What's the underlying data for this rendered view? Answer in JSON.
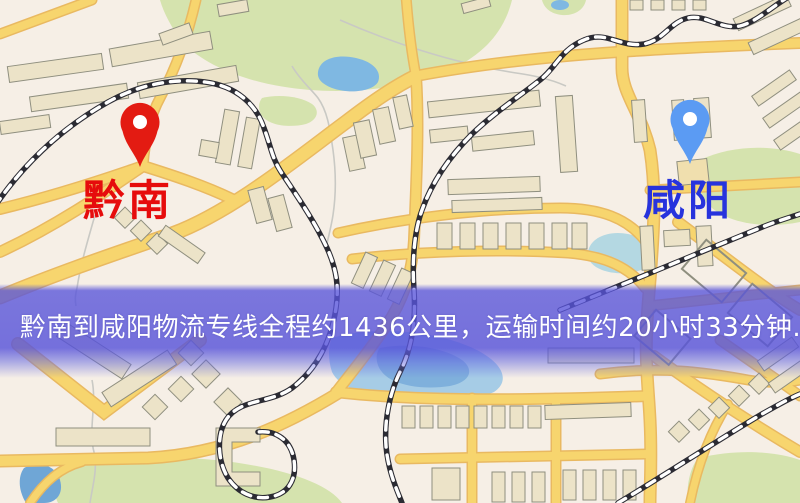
{
  "banner": {
    "text": "黔南到咸阳物流专线全程约1436公里，运输时间约20小时33分钟.",
    "background_color": "#5854da",
    "text_color": "#ffffff"
  },
  "route": {
    "from": "黔南",
    "to": "咸阳",
    "distance": "约1436公里",
    "duration": "约20小时33分钟"
  },
  "markers": {
    "origin": {
      "label": "黔南",
      "pin_color": "#e31b12",
      "label_color": "#e60c0c"
    },
    "destination": {
      "label": "咸阳",
      "pin_color": "#5b9bf3",
      "label_color": "#2733dd"
    }
  },
  "map_palette": {
    "background": "#f6efe6",
    "road": "#f7d56e",
    "road_casing": "#e9b961",
    "park": "#d5e3ae",
    "water": "#7fb8e2",
    "building": "#ece3c8",
    "building_outline": "#8f8f7f",
    "railway": "#2b2b33"
  }
}
